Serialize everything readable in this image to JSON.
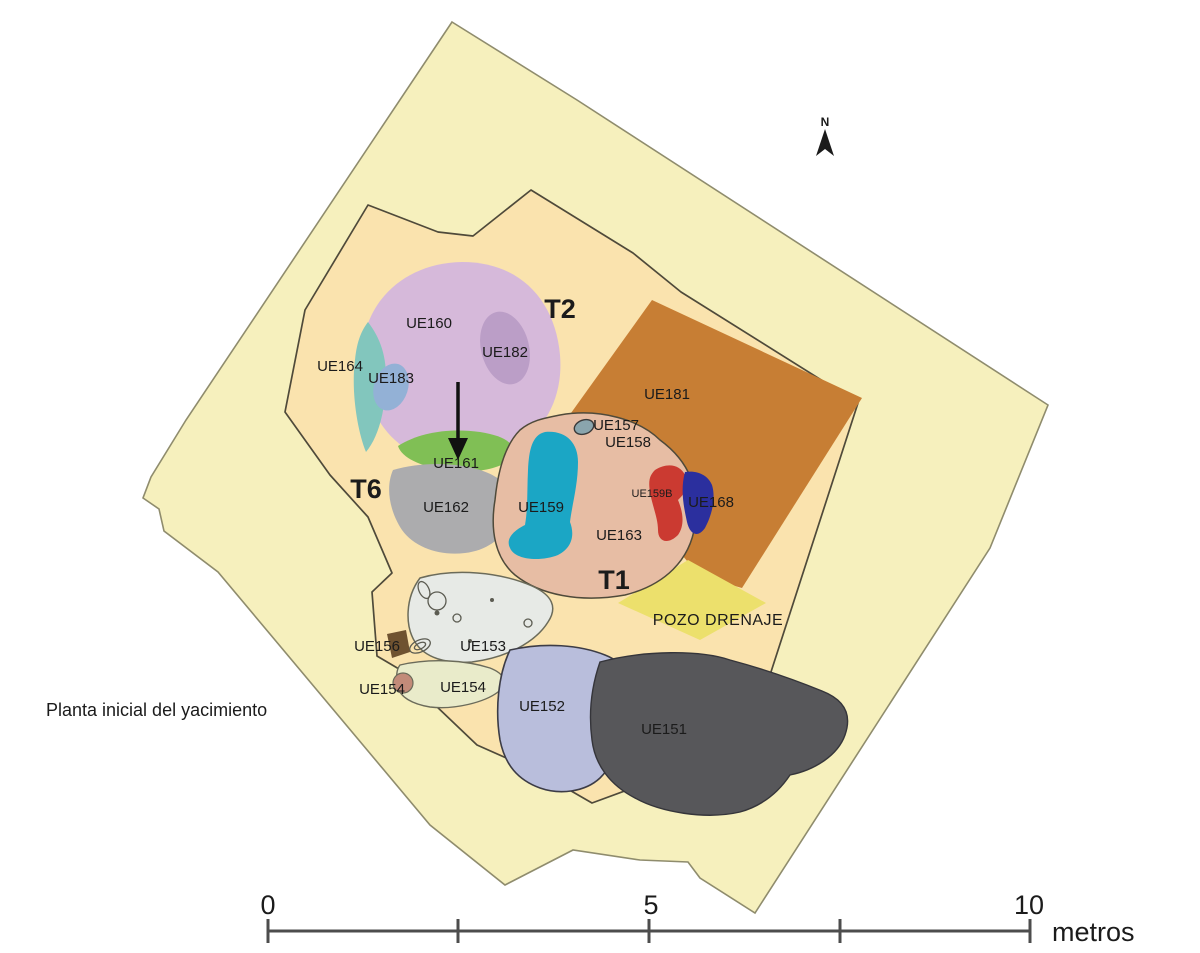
{
  "figure": {
    "caption": "Planta inicial del yacimiento",
    "north_label": "N"
  },
  "trench_labels": {
    "t2": "T2",
    "t6": "T6",
    "t1": "T1"
  },
  "unit_labels": {
    "ue160": "UE160",
    "ue182": "UE182",
    "ue164": "UE164",
    "ue183": "UE183",
    "ue161": "UE161",
    "ue162": "UE162",
    "ue159": "UE159",
    "ue157": "UE157",
    "ue158": "UE158",
    "ue181": "UE181",
    "ue159b": "UE159B",
    "ue168": "UE168",
    "ue163": "UE163",
    "pozo_drenaje": "POZO DRENAJE",
    "ue156": "UE156",
    "ue153": "UE153",
    "ue154_small": "UE154",
    "ue154": "UE154",
    "ue152": "UE152",
    "ue151": "UE151"
  },
  "scale_bar": {
    "tick0": "0",
    "tick5": "5",
    "tick10": "10",
    "unit": "metros"
  },
  "colors": {
    "outer_area": "#f6f0bd",
    "inner_area": "#fae3ae",
    "outline_outer": "#8f8c6d",
    "outline_inner": "#4f4a3a",
    "ue160": "#d6b9da",
    "ue182": "#bb9ec7",
    "ue164": "#82c6bd",
    "ue183": "#93b1d6",
    "ue161": "#80bf55",
    "ue162": "#acacae",
    "ue163": "#e7bda4",
    "ue159": "#1ba6c5",
    "ue157": "#8aa5ad",
    "ue181": "#c77e34",
    "ue159b": "#cb3a31",
    "ue168": "#2b2f9e",
    "pozo": "#ece06c",
    "ue153": "#e7eae6",
    "ue156": "#6f5230",
    "ue154": "#e9ebca",
    "ue154_small": "#c28b79",
    "ue152": "#b9bedc",
    "ue151": "#57575a",
    "arrow": "#111111",
    "scalebar": "#4d4d4d"
  }
}
